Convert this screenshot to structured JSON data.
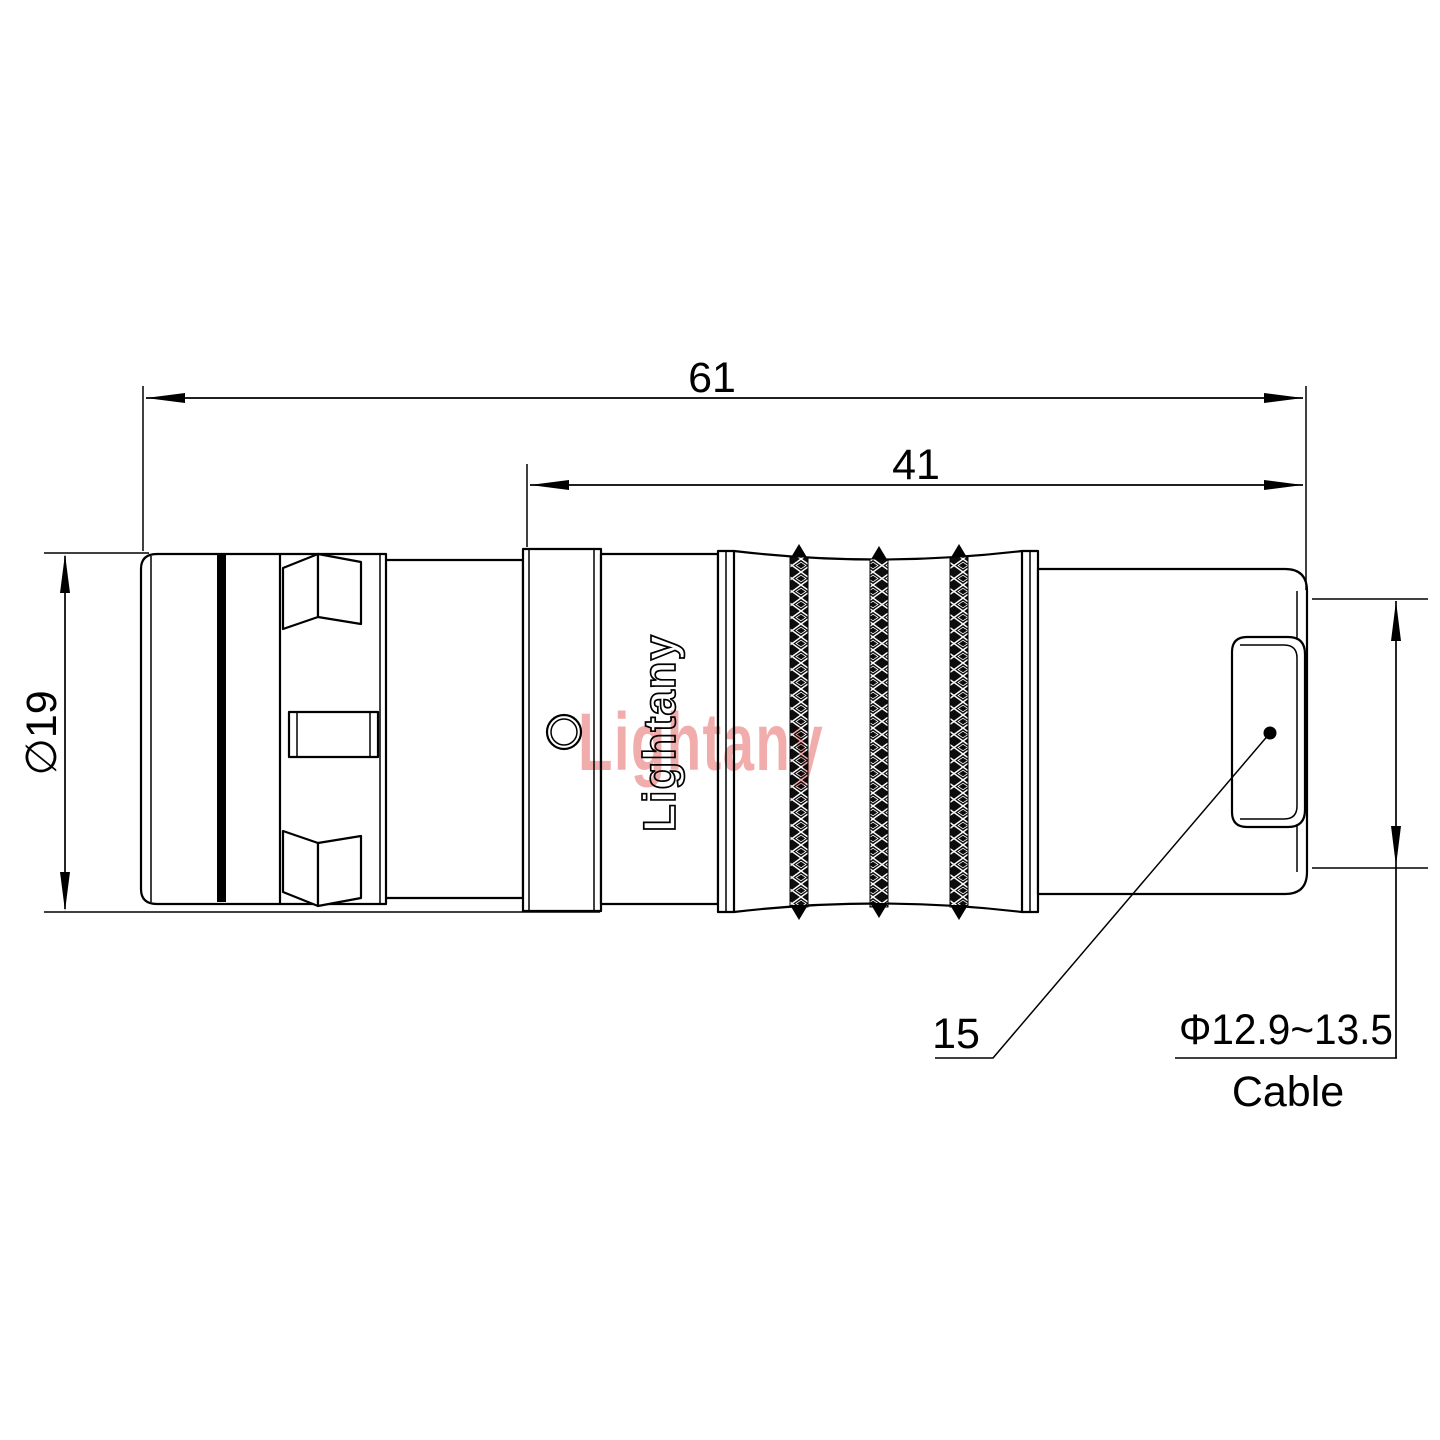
{
  "title": "connector-technical-drawing",
  "dims": {
    "overall_length": "61",
    "grip_length": "41",
    "front_diameter": "∅19",
    "ref_label": "15",
    "cable_diameter": "Φ12.9~13.5",
    "cable_label": "Cable"
  },
  "brand": {
    "body_text": "Lightany",
    "watermark_text": "Lightany"
  },
  "colors": {
    "line": "#000000",
    "watermark": "#ef9e9e",
    "knurl_fill": "#0d0d0d"
  }
}
